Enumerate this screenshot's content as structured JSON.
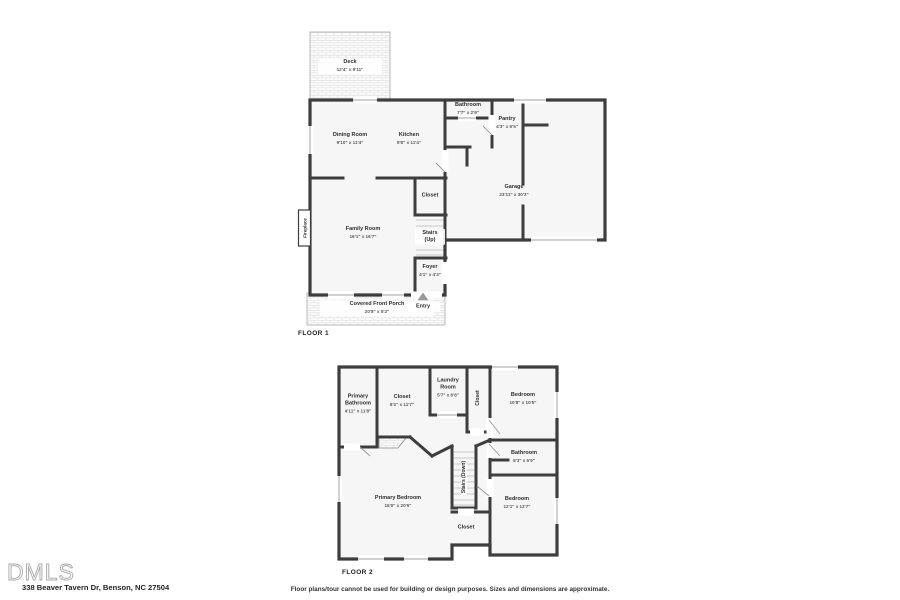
{
  "page": {
    "address": "338 Beaver Tavern Dr, Benson, NC 27504",
    "disclaimer": "Floor plans/tour cannot be used for building or design purposes. Sizes and dimensions are approximate.",
    "logo_text": "DMLS",
    "colors": {
      "wall": "#3d3d3d",
      "room_fill": "#f6f6f6",
      "hatch_line": "#e0e0e0",
      "window_line": "#b3b3b3",
      "label_text": "#2e2e2e"
    }
  },
  "floor1": {
    "label": "FLOOR 1",
    "rooms": {
      "deck": {
        "name": "Deck",
        "dims": "12'4\" x 9'11\""
      },
      "dining_room": {
        "name": "Dining Room",
        "dims": "9'10\" x 11'4\""
      },
      "kitchen": {
        "name": "Kitchen",
        "dims": "9'8\" x 11'4\""
      },
      "bathroom": {
        "name": "Bathroom",
        "dims": "7'7\" x 2'9\""
      },
      "pantry": {
        "name": "Pantry",
        "dims": "4'3\" x 6'5\""
      },
      "garage": {
        "name": "Garage",
        "dims": "23'11\" x 30'3\""
      },
      "closet": {
        "name": "Closet"
      },
      "family_room": {
        "name": "Family Room",
        "dims": "16'1\" x 16'7\""
      },
      "stairs": {
        "name": "Stairs (Up)"
      },
      "fireplace": {
        "name": "Fireplace"
      },
      "foyer": {
        "name": "Foyer",
        "dims": "4'1\" x 4'3\""
      },
      "covered_front_porch": {
        "name": "Covered Front Porch",
        "dims": "20'8\" x 5'2\""
      },
      "entry": {
        "name": "Entry"
      }
    }
  },
  "floor2": {
    "label": "FLOOR 2",
    "rooms": {
      "primary_bathroom": {
        "name": "Primary Bathroom",
        "dims": "4'11\" x 11'8\""
      },
      "closet_large": {
        "name": "Closet",
        "dims": "8'2\" x 11'7\""
      },
      "laundry_room": {
        "name": "Laundry Room",
        "dims": "5'7\" x 6'8\""
      },
      "closet_hall": {
        "name": "Closet"
      },
      "bedroom_top": {
        "name": "Bedroom",
        "dims": "10'8\" x 10'5\""
      },
      "bathroom": {
        "name": "Bathroom",
        "dims": "8'3\" x 5'9\""
      },
      "stairs": {
        "name": "Stairs (Down)"
      },
      "closet_bottom": {
        "name": "Closet"
      },
      "bedroom_bottom": {
        "name": "Bedroom",
        "dims": "12'1\" x 12'7\""
      },
      "primary_bedroom": {
        "name": "Primary Bedroom",
        "dims": "16'0\" x 20'5\""
      }
    }
  }
}
